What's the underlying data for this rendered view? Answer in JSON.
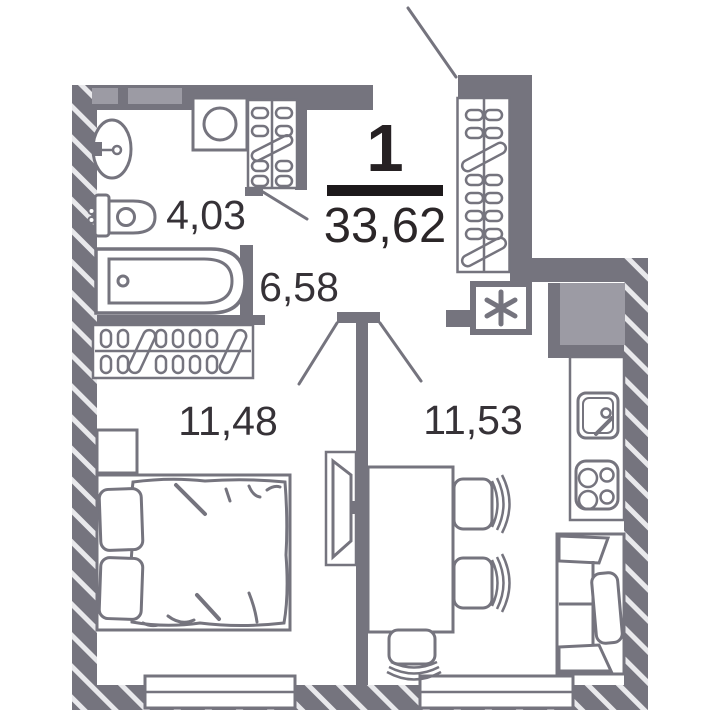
{
  "plan": {
    "type": "apartment-floor-plan",
    "unit": {
      "number": "1",
      "total_area": "33,62"
    },
    "rooms": [
      {
        "name": "bathroom",
        "area": "4,03"
      },
      {
        "name": "hallway",
        "area": "6,58"
      },
      {
        "name": "bedroom",
        "area": "11,48"
      },
      {
        "name": "kitchen-living-room",
        "area": "11,53"
      }
    ],
    "icons": {
      "shaft": "six-spoke-asterisk",
      "fixtures": [
        "wall-sink",
        "washing-machine",
        "towel-dryer-rack",
        "toilet",
        "bathtub",
        "coat-hanger-wardrobe",
        "bedroom-wardrobe",
        "nightstand",
        "double-bed",
        "tv",
        "dining-table",
        "chair",
        "kitchen-counter",
        "kitchen-sink",
        "stove-4-burners",
        "sofa",
        "vent-shaft",
        "entrance-leader-line",
        "door-swing",
        "window"
      ]
    },
    "colors": {
      "wall": "#75747e",
      "wall_light": "#9c9ba4",
      "hatch_stripe": "#e9e9ec",
      "label_text": "#363237",
      "accent_black": "#241f21",
      "background": "#ffffff"
    }
  }
}
